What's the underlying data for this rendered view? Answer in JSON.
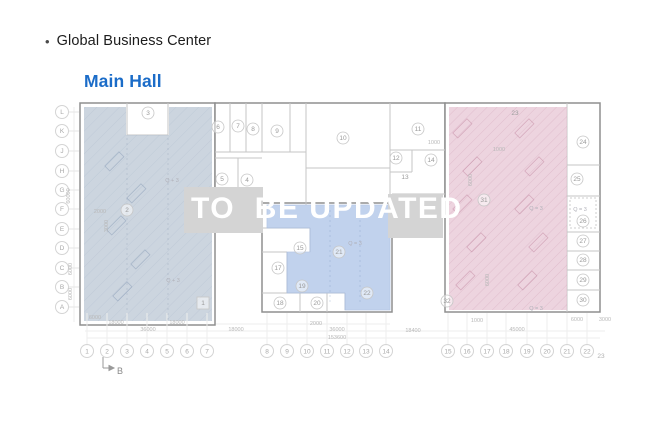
{
  "header": {
    "bullet": "•",
    "title": "Global Business Center",
    "subtitle": "Main Hall"
  },
  "watermark": {
    "text": "TO  BE UPDATED"
  },
  "colors": {
    "subtitle_blue": "#1b6cc8",
    "zone_left": "#b9c5d3",
    "zone_middle_blue": "#b4c9ea",
    "zone_right_pink": "#e6c4d2",
    "watermark_box": "#d4d4d4",
    "building_outline": "#8f8f8f",
    "inner_wall": "#c6c6c6",
    "axis_text": "#a8a8a8",
    "dimension_text": "#b8b8b8"
  },
  "floorplan": {
    "row_axis": [
      "L",
      "K",
      "J",
      "H",
      "G",
      "F",
      "E",
      "D",
      "C",
      "B",
      "A"
    ],
    "col_axis": [
      "1",
      "2",
      "3",
      "4",
      "5",
      "6",
      "7",
      "8",
      "9",
      "10",
      "11",
      "12",
      "13",
      "14",
      "15",
      "16",
      "17",
      "18",
      "19",
      "20",
      "21",
      "22"
    ],
    "col_axis_extra": "23",
    "section_marker": "B",
    "rooms": [
      {
        "label": "3",
        "x": 148,
        "y": 113
      },
      {
        "label": "2",
        "x": 127,
        "y": 210
      },
      {
        "label": "1",
        "x": 203,
        "y": 303,
        "shape": "square"
      },
      {
        "label": "6",
        "x": 218,
        "y": 127
      },
      {
        "label": "7",
        "x": 238,
        "y": 126
      },
      {
        "label": "8",
        "x": 253,
        "y": 129
      },
      {
        "label": "9",
        "x": 277,
        "y": 131
      },
      {
        "label": "5",
        "x": 222,
        "y": 179
      },
      {
        "label": "4",
        "x": 247,
        "y": 180
      },
      {
        "label": "10",
        "x": 343,
        "y": 138
      },
      {
        "label": "11",
        "x": 418,
        "y": 129
      },
      {
        "label": "12",
        "x": 396,
        "y": 158
      },
      {
        "label": "13",
        "x": 405,
        "y": 177,
        "shape": "plain"
      },
      {
        "label": "14",
        "x": 431,
        "y": 160
      },
      {
        "label": "15",
        "x": 300,
        "y": 248
      },
      {
        "label": "17",
        "x": 278,
        "y": 268
      },
      {
        "label": "19",
        "x": 302,
        "y": 286
      },
      {
        "label": "18",
        "x": 280,
        "y": 303
      },
      {
        "label": "20",
        "x": 317,
        "y": 303
      },
      {
        "label": "21",
        "x": 339,
        "y": 252
      },
      {
        "label": "22",
        "x": 367,
        "y": 293
      },
      {
        "label": "23",
        "x": 515,
        "y": 113,
        "shape": "plain"
      },
      {
        "label": "31",
        "x": 484,
        "y": 200
      },
      {
        "label": "32",
        "x": 447,
        "y": 301
      },
      {
        "label": "24",
        "x": 583,
        "y": 142
      },
      {
        "label": "25",
        "x": 577,
        "y": 179
      },
      {
        "label": "26",
        "x": 583,
        "y": 221
      },
      {
        "label": "27",
        "x": 583,
        "y": 241
      },
      {
        "label": "28",
        "x": 583,
        "y": 260
      },
      {
        "label": "29",
        "x": 583,
        "y": 280
      },
      {
        "label": "30",
        "x": 583,
        "y": 300
      }
    ],
    "annotations": [
      {
        "text": "Q + 3",
        "x": 172,
        "y": 182
      },
      {
        "text": "Q + 3",
        "x": 173,
        "y": 282
      },
      {
        "text": "Q = 3",
        "x": 355,
        "y": 245
      },
      {
        "text": "Q = 3",
        "x": 536,
        "y": 210
      },
      {
        "text": "Q = 3",
        "x": 580,
        "y": 211
      },
      {
        "text": "Q = 3",
        "x": 536,
        "y": 310
      }
    ],
    "dimensions": [
      {
        "text": "6000",
        "x": 95,
        "y": 319
      },
      {
        "text": "18000",
        "x": 116,
        "y": 324
      },
      {
        "text": "18000",
        "x": 177,
        "y": 324
      },
      {
        "text": "36000",
        "x": 148,
        "y": 331
      },
      {
        "text": "18000",
        "x": 236,
        "y": 331
      },
      {
        "text": "2000",
        "x": 316,
        "y": 325
      },
      {
        "text": "36000",
        "x": 337,
        "y": 331
      },
      {
        "text": "18400",
        "x": 413,
        "y": 332
      },
      {
        "text": "1000",
        "x": 477,
        "y": 322
      },
      {
        "text": "45000",
        "x": 517,
        "y": 331
      },
      {
        "text": "6000",
        "x": 577,
        "y": 321
      },
      {
        "text": "3000",
        "x": 605,
        "y": 321
      },
      {
        "text": "153600",
        "x": 337,
        "y": 339
      },
      {
        "text": "60000",
        "x": 70,
        "y": 196,
        "vertical": true
      },
      {
        "text": "6000",
        "x": 72,
        "y": 269,
        "vertical": true
      },
      {
        "text": "6000",
        "x": 72,
        "y": 294,
        "vertical": true
      },
      {
        "text": "1000",
        "x": 434,
        "y": 144
      },
      {
        "text": "1000",
        "x": 499,
        "y": 151
      },
      {
        "text": "2000",
        "x": 100,
        "y": 213
      },
      {
        "text": "3000",
        "x": 108,
        "y": 226,
        "vertical": true
      },
      {
        "text": "6000",
        "x": 472,
        "y": 180,
        "vertical": true
      },
      {
        "text": "6000",
        "x": 489,
        "y": 280,
        "vertical": true
      }
    ]
  }
}
